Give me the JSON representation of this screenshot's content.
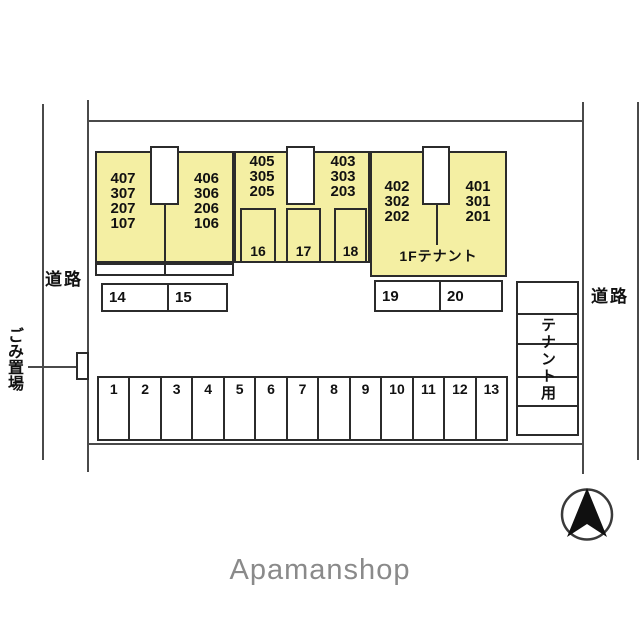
{
  "plan": {
    "roads": {
      "left": "道路",
      "right": "道路"
    },
    "garbage": {
      "label": "ごみ置場"
    },
    "blocks": {
      "left_a": {
        "units": [
          "407",
          "307",
          "207",
          "107"
        ]
      },
      "left_b": {
        "units": [
          "406",
          "306",
          "206",
          "106"
        ]
      },
      "mid_a": {
        "units": [
          "405",
          "305",
          "205"
        ]
      },
      "mid_b": {
        "units": [
          "403",
          "303",
          "203"
        ]
      },
      "right_a": {
        "units": [
          "402",
          "302",
          "202"
        ]
      },
      "right_b": {
        "units": [
          "401",
          "301",
          "201"
        ]
      },
      "tenant_floor_label": "1Fテナント"
    },
    "covered_stalls": [
      "16",
      "17",
      "18"
    ],
    "parking": {
      "row_14_15": [
        "14",
        "15"
      ],
      "row_19_20": [
        "19",
        "20"
      ],
      "bottom_row": [
        "1",
        "2",
        "3",
        "4",
        "5",
        "6",
        "7",
        "8",
        "9",
        "10",
        "11",
        "12",
        "13"
      ],
      "tenant_column_label": "テナント用"
    },
    "brand": "Apamanshop",
    "colors": {
      "building_fill": "#F4EFA3",
      "edge": "#2b2b2b",
      "line": "#4a4a4a",
      "brand_text": "#8a8a8a"
    }
  }
}
